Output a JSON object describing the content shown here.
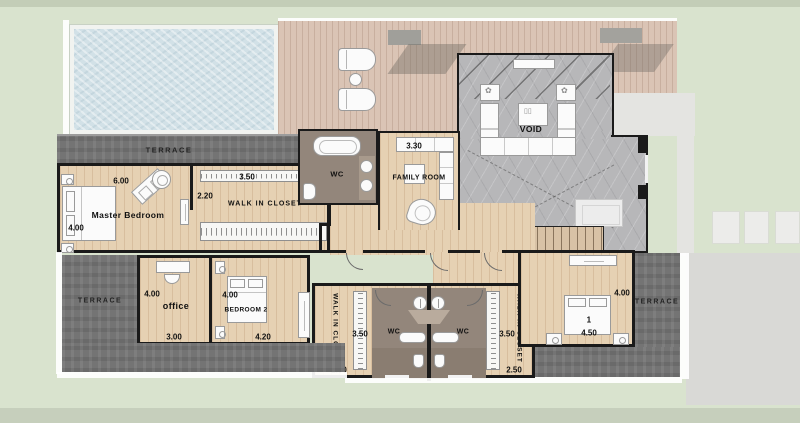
{
  "title": "villa-upper-floor-plan",
  "colors": {
    "lawn": "#d9e3ce",
    "pool": "#d2e1e7",
    "deck": "#dac4b5",
    "wood_floor": "#e6d1b3",
    "terrace": "#747474",
    "void_gray": "#b7b7b9",
    "wc_floor": "#93867b",
    "wall": "#1a1a1a",
    "path": "#e4e4e1"
  },
  "terraces": {
    "top": "TERRACE",
    "left": "TERRACE",
    "right": "TERRACE"
  },
  "rooms": {
    "master": {
      "name": "Master Bedroom",
      "dim_width": "6.00",
      "dim_height": "4.00"
    },
    "master_closet": {
      "name": "WALK IN CLOSET",
      "dim_width": "3.50",
      "dim_depth": "2.20"
    },
    "master_wc": {
      "name": "WC"
    },
    "family": {
      "name": "FAMILY ROOM",
      "dim": "3.30"
    },
    "void": {
      "name": "VOID"
    },
    "office": {
      "name": "office",
      "dim_height": "4.00",
      "dim_width": "3.00"
    },
    "bedroom2": {
      "name": "BEDROOM 2",
      "dim_height": "4.00",
      "dim_width": "4.20"
    },
    "closet_a": {
      "name": "WALK IN CLOSET",
      "dim_height": "3.50",
      "dim_width": "2.50"
    },
    "wc_a": {
      "name": "WC"
    },
    "wc_b": {
      "name": "WC"
    },
    "closet_b": {
      "name": "WALK IN CLOSET",
      "dim_height": "3.50",
      "dim_width": "2.50"
    },
    "bedroom1": {
      "name": "BEDROOM",
      "number": "1",
      "dim_height": "4.00",
      "dim_width": "4.50"
    }
  }
}
